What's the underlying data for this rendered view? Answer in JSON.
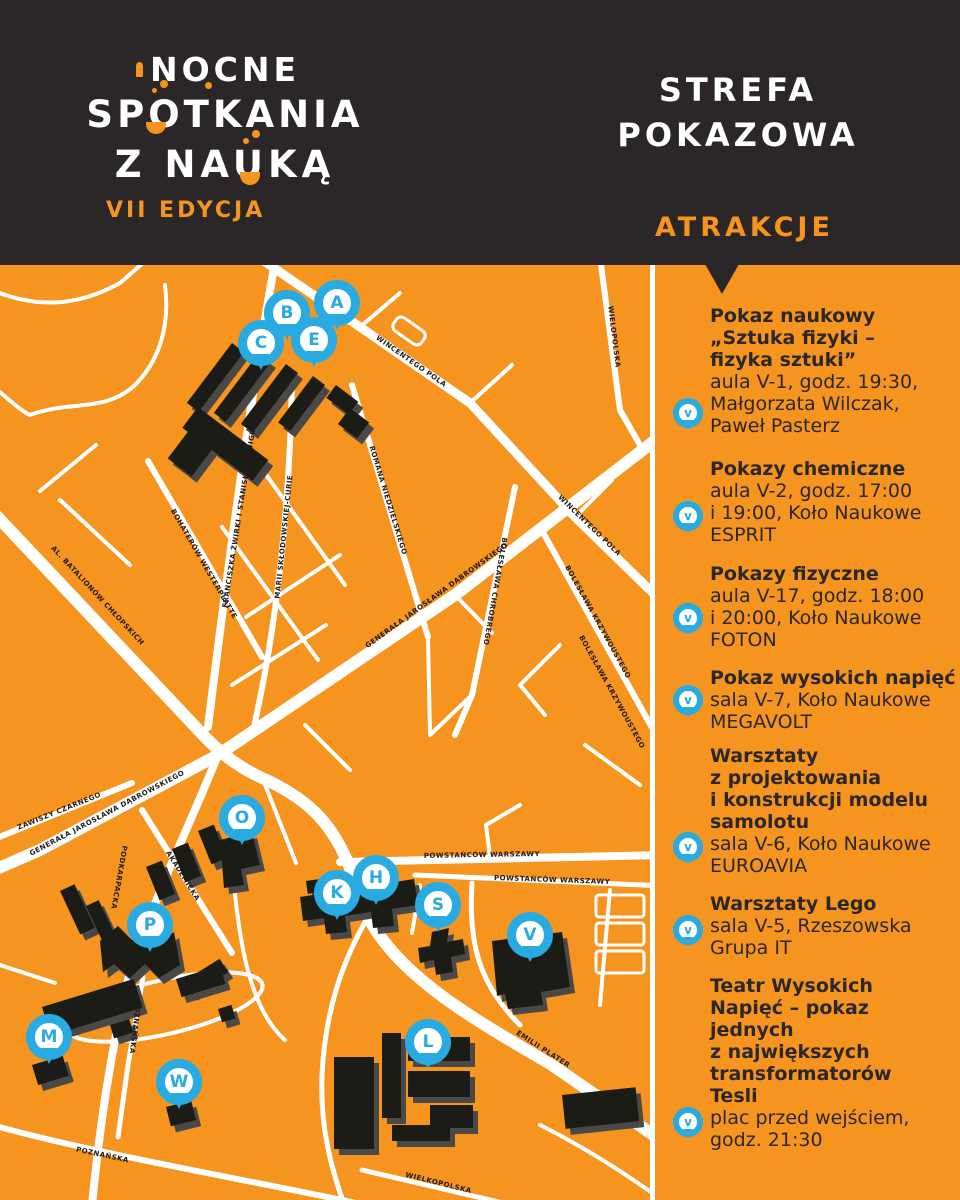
{
  "logo": {
    "line1": "NOCNE",
    "line2": "SPOTKANIA",
    "line3": "Z NAUKĄ",
    "edition": "VII EDYCJA"
  },
  "panel": {
    "title_line1": "STREFA",
    "title_line2": "POKAZOWA",
    "subtitle": "ATRAKCJE"
  },
  "attractions": [
    {
      "pin": "V",
      "title": "Pokaz naukowy\n„Sztuka fizyki –\nfizyka sztuki”",
      "details": "aula V-1, godz. 19:30,\nMałgorzata Wilczak,\nPaweł Pasterz"
    },
    {
      "pin": "V",
      "title": "Pokazy chemiczne",
      "details": "aula V-2, godz. 17:00\ni 19:00, Koło Naukowe\nESPRIT"
    },
    {
      "pin": "V",
      "title": "Pokazy fizyczne",
      "details": "aula V-17, godz. 18:00\ni 20:00, Koło Naukowe\nFOTON"
    },
    {
      "pin": "V",
      "title": "Pokaz wysokich napięć",
      "details": "sala V-7, Koło Naukowe\nMEGAVOLT"
    },
    {
      "pin": "V",
      "title": "Warsztaty\nz projektowania\ni konstrukcji modelu\nsamolotu",
      "details": "sala V-6, Koło Naukowe\nEUROAVIA"
    },
    {
      "pin": "V",
      "title": "Warsztaty Lego",
      "details": "sala V-5, Rzeszowska\nGrupa IT"
    },
    {
      "pin": "V",
      "title": "Teatr Wysokich\nNapięć – pokaz\njednych\nz największych\ntransformatorów\nTesli",
      "details": "plac przed wejściem,\ngodz. 21:30"
    }
  ],
  "map": {
    "markers": [
      {
        "letter": "A"
      },
      {
        "letter": "B"
      },
      {
        "letter": "C"
      },
      {
        "letter": "E"
      },
      {
        "letter": "O"
      },
      {
        "letter": "P"
      },
      {
        "letter": "K"
      },
      {
        "letter": "H"
      },
      {
        "letter": "S"
      },
      {
        "letter": "V"
      },
      {
        "letter": "M"
      },
      {
        "letter": "W"
      },
      {
        "letter": "L"
      }
    ],
    "street_labels": [
      {
        "name": "WINCENTEGO POLA"
      },
      {
        "name": "WINCENTEGO POLA"
      },
      {
        "name": "GENERAŁA JAROSŁAWA DĄBROWSKIEGO"
      },
      {
        "name": "GENERAŁA JAROSŁAWA DĄBROWSKIEGO"
      },
      {
        "name": "FRANCISZKA ŻWIRKI I STANISŁAWA WIGURY"
      },
      {
        "name": "MARII SKŁODOWSKIEJ-CURIE"
      },
      {
        "name": "ROMANA NIEDZIELSKIEGO"
      },
      {
        "name": "BOHATERÓW WESTERPLATTE"
      },
      {
        "name": "AL. BATALIONÓW CHŁOPSKICH"
      },
      {
        "name": "BOLESŁAWA CHROBREGO"
      },
      {
        "name": "BOLESŁAWA KRZYWOUSTEGO"
      },
      {
        "name": "WIELOPOLSKA"
      },
      {
        "name": "POWSTAŃCÓW WARSZAWY"
      },
      {
        "name": "POWSTAŃCÓW WARSZAWY"
      },
      {
        "name": "ZAWISZY CZARNEGO"
      },
      {
        "name": "AKADEMICKA"
      },
      {
        "name": "PODKARPACKA"
      },
      {
        "name": "POZNAŃSKA"
      },
      {
        "name": "POZNAŃSKA"
      },
      {
        "name": "WIELKOPOLSKA"
      },
      {
        "name": "EMILII PLATER"
      },
      {
        "name": "BOLESŁAWA KRZYWOUSTEGO"
      }
    ]
  },
  "colors": {
    "orange": "#F5941F",
    "dark": "#2B2728",
    "blue": "#29ABE2",
    "white": "#FFFFFF",
    "building": "#1D1B19"
  }
}
